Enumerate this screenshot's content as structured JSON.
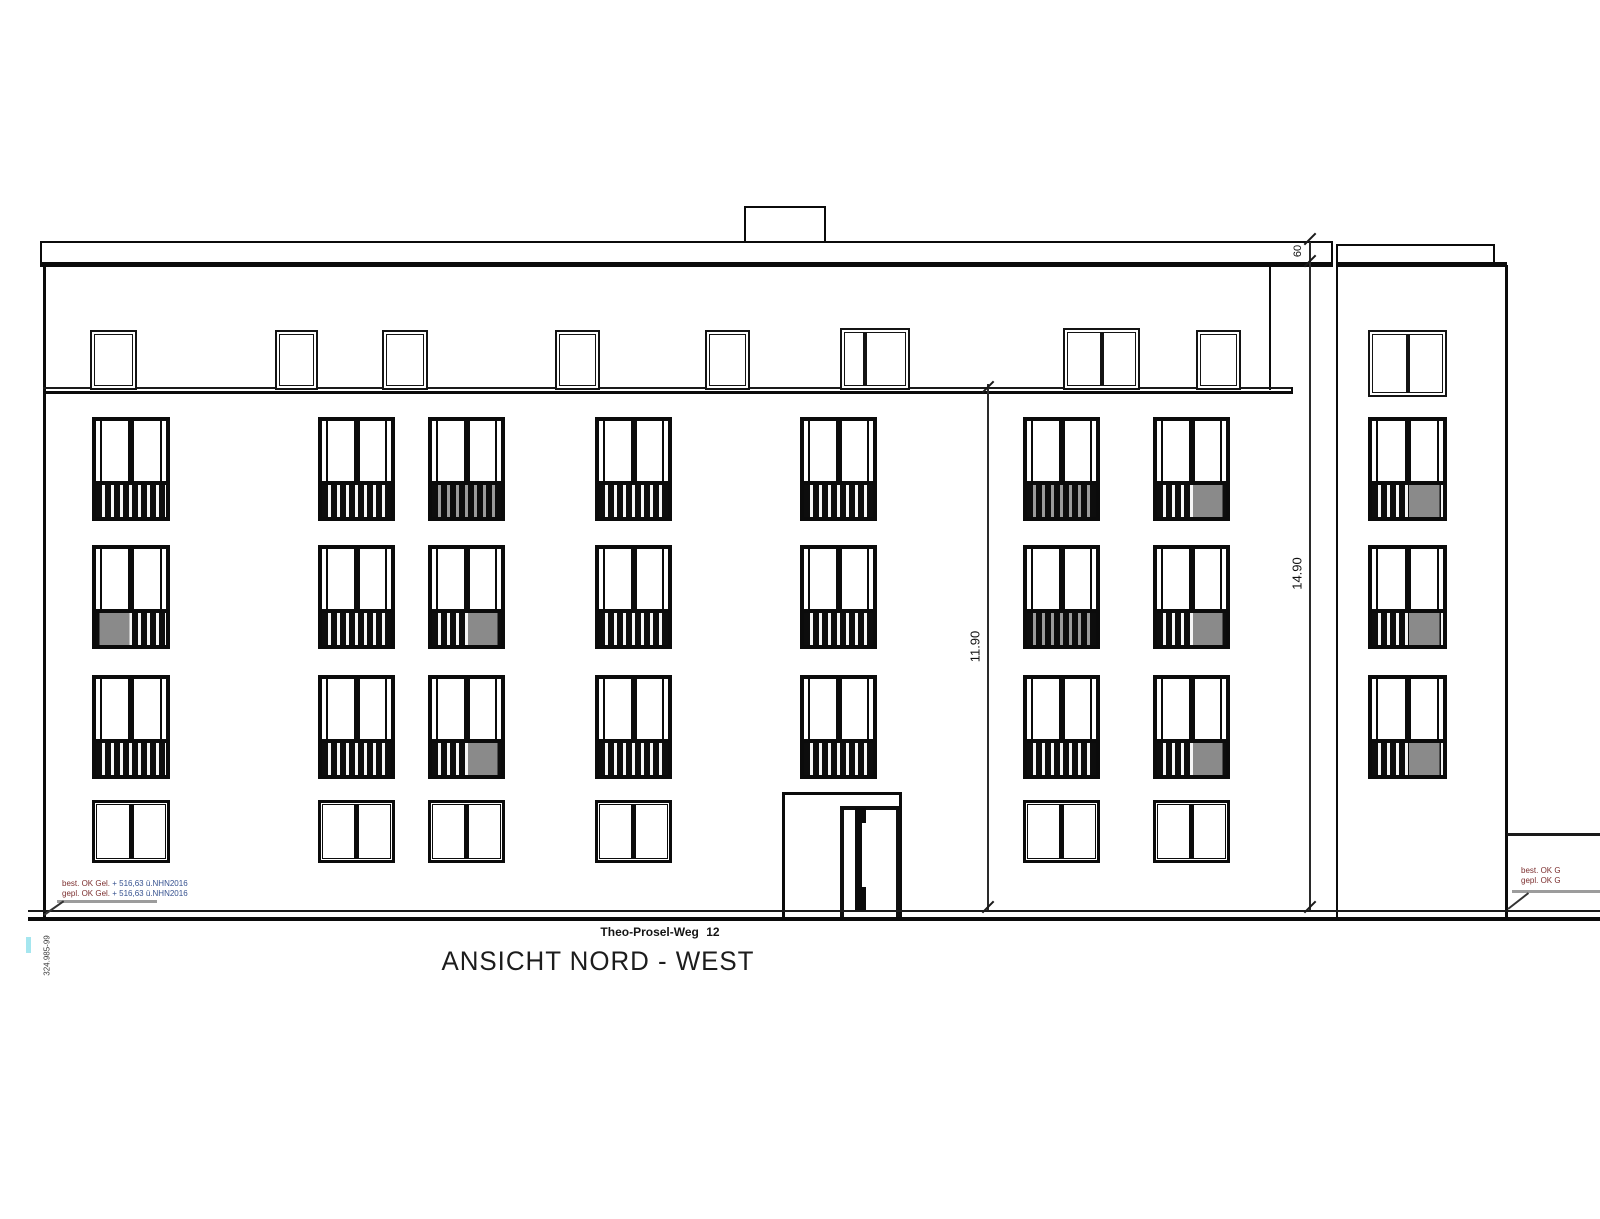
{
  "drawing": {
    "title": "ANSICHT NORD - WEST",
    "street_label": "Theo-Prosel-Weg 12"
  },
  "dimensions": {
    "facade_height_m": "11.90",
    "total_height_m": "14.90",
    "parapet_cm": "60"
  },
  "ground_notes": {
    "left_line1_label": "best. OK Gel.",
    "left_line1_value": "+ 516,63 ü.NHN2016",
    "left_line2_label": "gepl. OK Gel.",
    "left_line2_value": "+ 516,63 ü.NHN2016",
    "right_line1_label": "best. OK G",
    "right_line2_label": "gepl. OK G",
    "benchmark_label": "324.985-99"
  },
  "colors": {
    "line_black": "#0b0b0b",
    "railing_gray": "#8a8a8a",
    "note_red": "#7c2f2f",
    "note_blue": "#35518f",
    "survey_cyan": "#a5e6ef"
  }
}
